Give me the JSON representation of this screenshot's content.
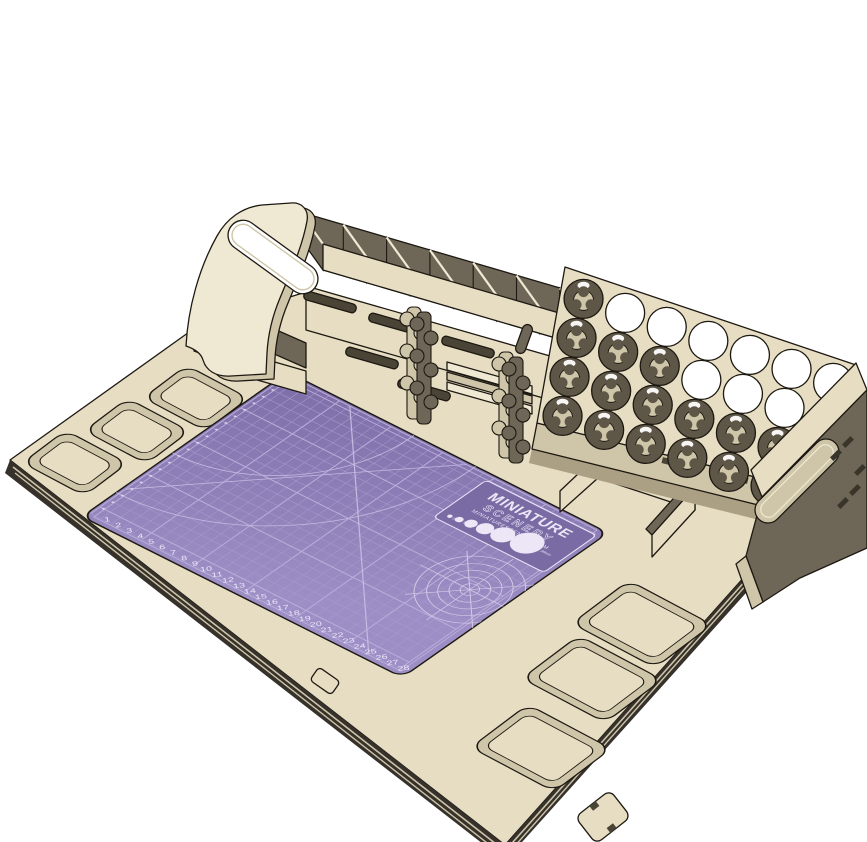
{
  "meta": {
    "description": "3D CAD render of a laser-cut hobby painting workstation with cutting mat, paint bottle rack, tool compartments, carry handle and parts trays",
    "background": "#ffffff"
  },
  "colors": {
    "wood_top": "#e6ddc2",
    "wood_light": "#efe8d2",
    "wood_mid": "#cfc6aa",
    "wood_dark": "#6e6757",
    "wood_deep": "#4a4437",
    "outline": "#1d1912",
    "edge_dark": "#36312a",
    "edge_stripe": "#cdc5a9",
    "mat_purple": "#8272ac",
    "mat_purple_light": "#9d8ec5",
    "mat_grid": "#a99cce",
    "mat_major": "#bbaeda",
    "mat_ink": "#ece6f7",
    "hole_white": "#ffffff"
  },
  "mat": {
    "brand_line1": "MINIATURE",
    "brand_line2": "SCENERY",
    "brand_url": "MINIATURESCENERY.COM",
    "grid": {
      "cols": 30,
      "rows": 21,
      "major_every": 5
    },
    "ruler_numbers": [
      1,
      2,
      3,
      4,
      5,
      6,
      7,
      8,
      9,
      10,
      11,
      12,
      13,
      14,
      15,
      16,
      17,
      18,
      19,
      20,
      21,
      22,
      23,
      24,
      25,
      26,
      27,
      28
    ],
    "scale_circles": [
      {
        "label": "2mm",
        "r": 0.2
      },
      {
        "label": "5mm",
        "r": 0.32
      },
      {
        "label": "10mm",
        "r": 0.48
      },
      {
        "label": "15mm",
        "r": 0.66
      },
      {
        "label": "20mm",
        "r": 0.9
      },
      {
        "label": "30mm",
        "r": 1.25
      }
    ]
  },
  "rack": {
    "rows": 4,
    "cols": 7,
    "open_holes": [
      "0,1",
      "0,2",
      "0,3",
      "0,4",
      "0,5",
      "0,6",
      "1,3",
      "1,4",
      "1,5",
      "1,6",
      "2,6"
    ]
  },
  "organizer": {
    "compartments": 6
  },
  "trays": {
    "left_count": 3,
    "front_count": 3
  }
}
